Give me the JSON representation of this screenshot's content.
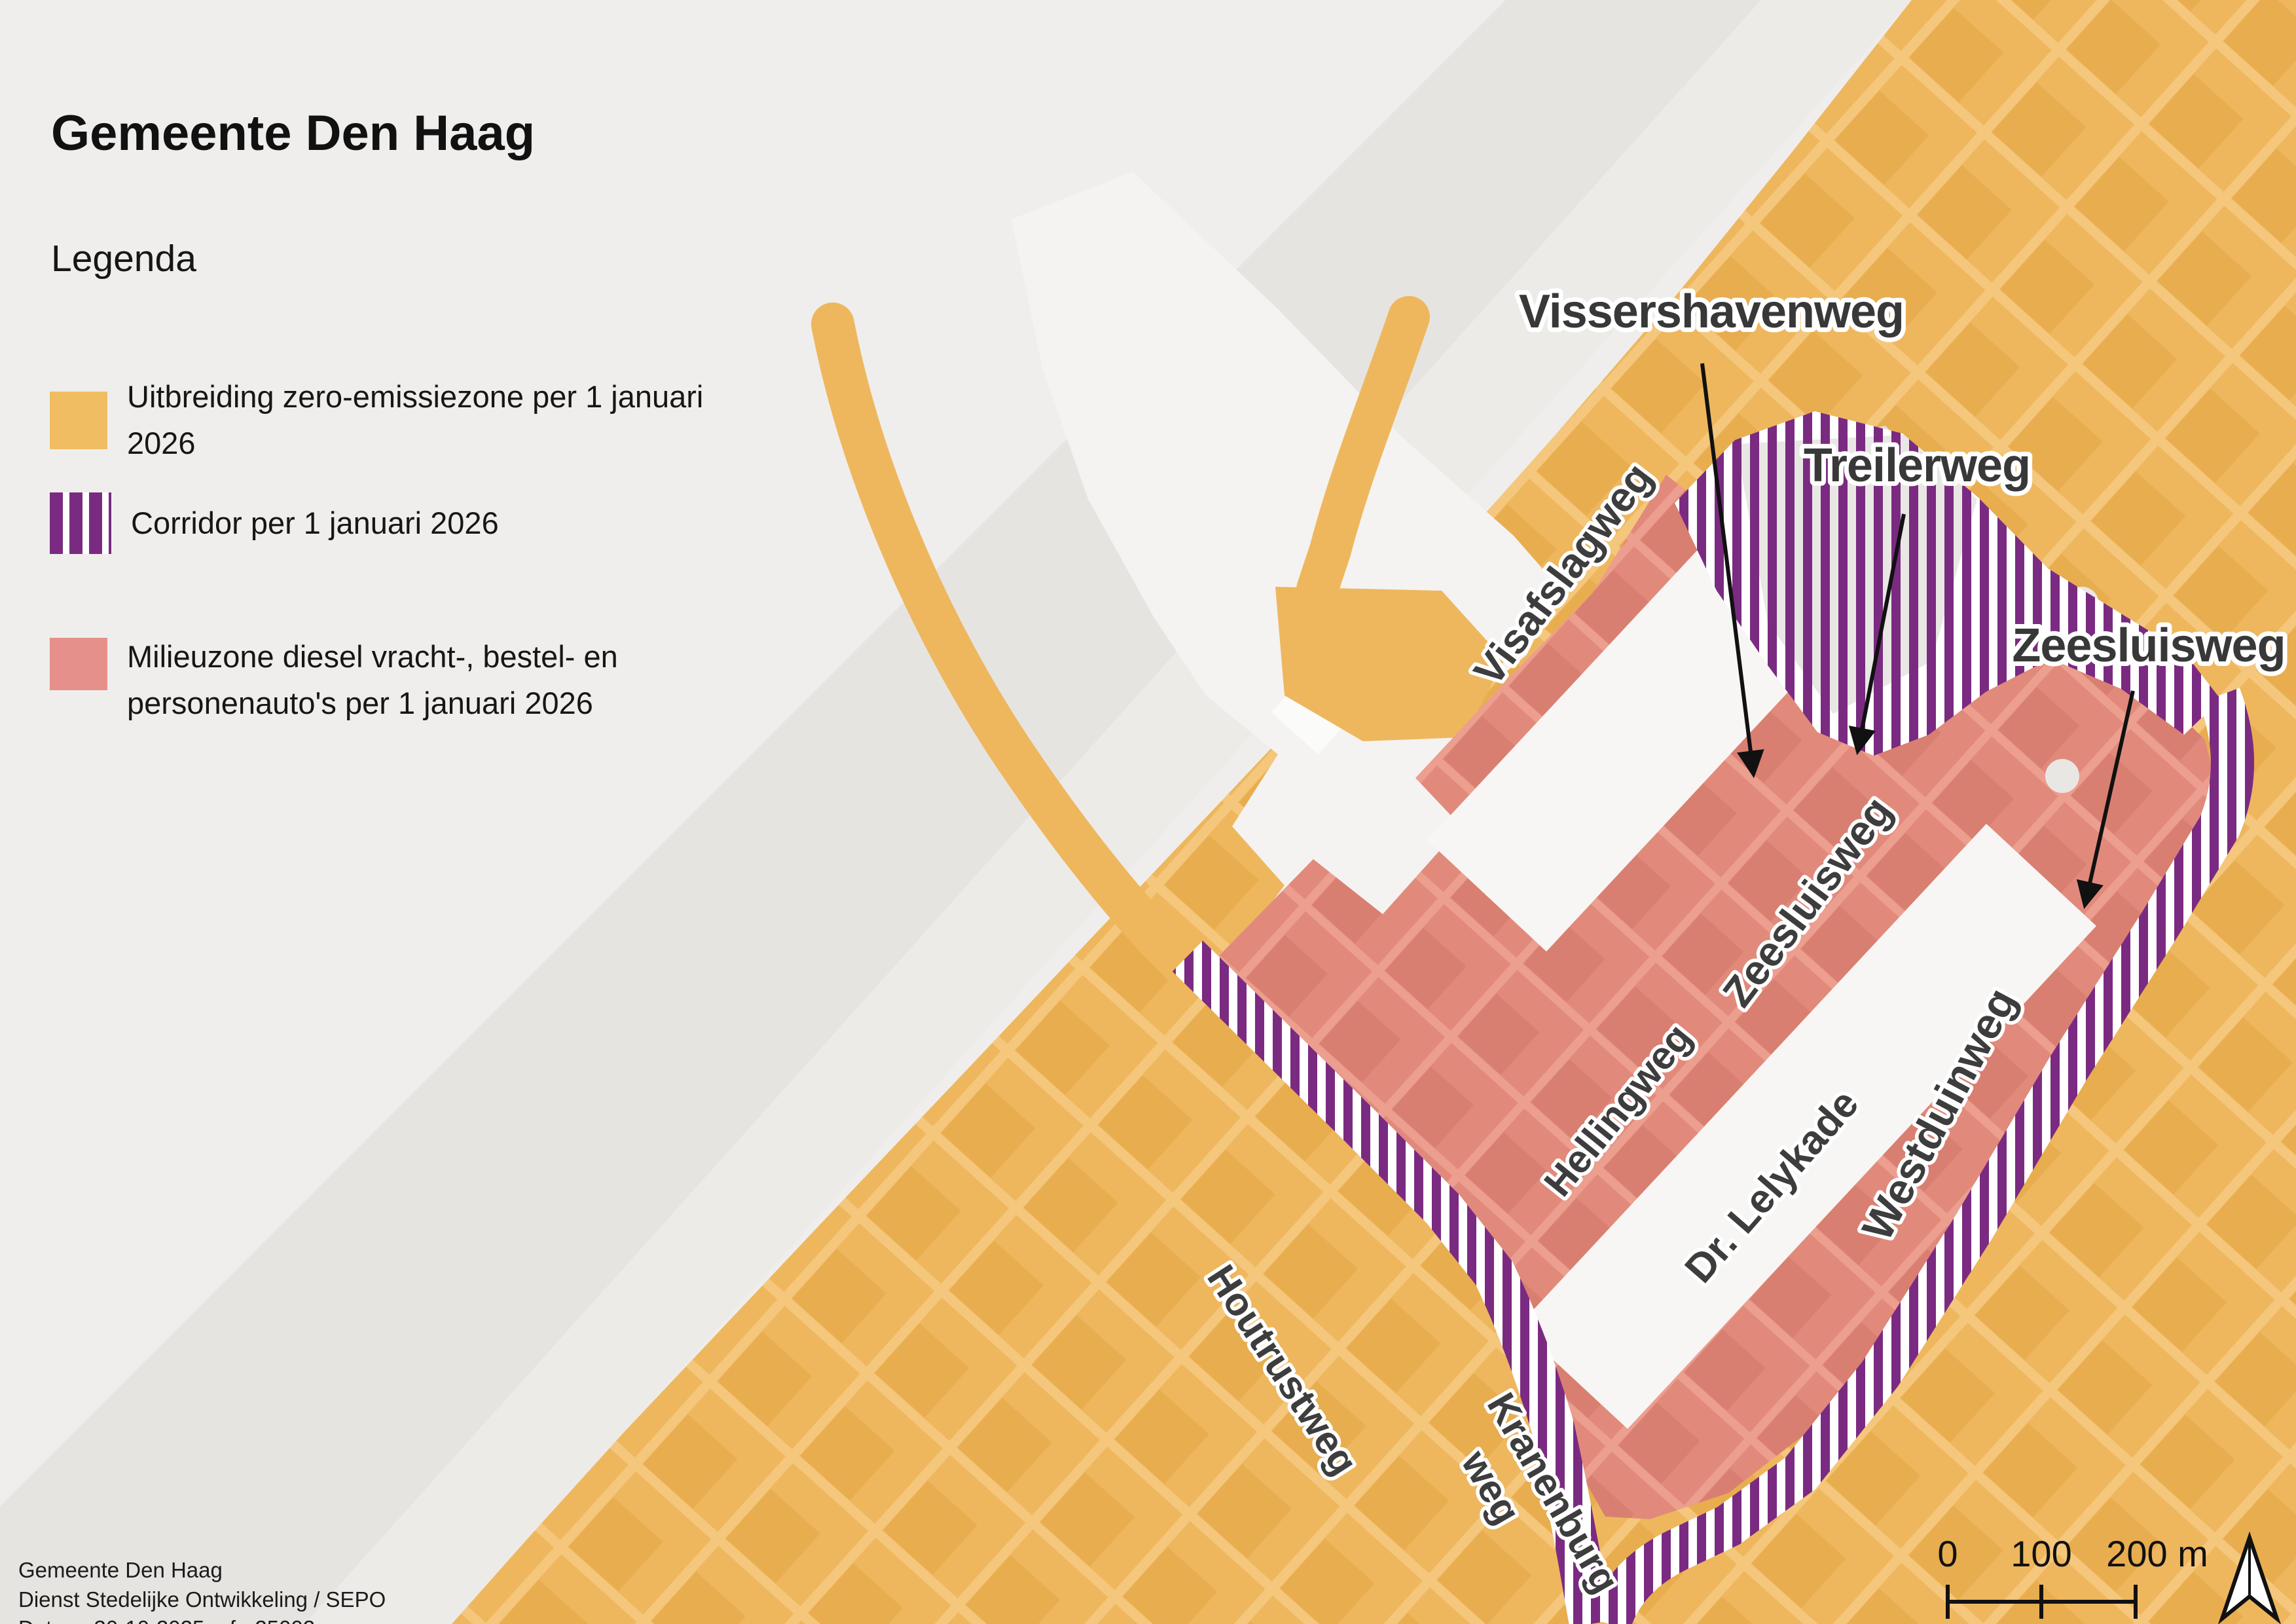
{
  "title": "Gemeente Den Haag",
  "legend": {
    "heading": "Legenda",
    "items": [
      {
        "swatch": "orange-fill",
        "color": "#f0bd62",
        "label": "Uitbreiding zero-emissiezone per 1 januari 2026"
      },
      {
        "swatch": "purple-stripes",
        "color": "#7a2b81",
        "label": "Corridor per 1 januari 2026"
      },
      {
        "swatch": "red-fill",
        "color": "#e5908a",
        "label": "Milieuzone diesel vracht-, bestel- en personenauto's per 1 januari 2026"
      }
    ]
  },
  "map": {
    "street_labels": {
      "visafslagweg": "Visafslagweg",
      "zeesluisweg": "Zeesluisweg",
      "hellingweg": "Hellingweg",
      "dr_lelykade": "Dr. Lelykade",
      "westduinweg": "Westduinweg",
      "houtrustweg": "Houtrustweg",
      "kranenburgweg_line1": "Kranenburg",
      "kranenburgweg_line2": "weg"
    },
    "annotations": [
      "Vissershavenweg",
      "Treilerweg",
      "Zeesluisweg"
    ]
  },
  "scale_bar": {
    "labels": [
      "0",
      "100",
      "200 m"
    ]
  },
  "attribution": {
    "line1": "Gemeente Den Haag",
    "line2": "Dienst Stedelijke Ontwikkeling / SEPO",
    "line3": "Datum: 30-10-2025 refnr25002"
  },
  "colors": {
    "zone_orange": "#eeb75e",
    "corridor_purple": "#7a2b81",
    "milieuzone_red": "#e18a7c",
    "sea_gray": "#efeeec",
    "beach_gray": "#e6e4e1",
    "harbor_water": "#f4f3f1"
  }
}
